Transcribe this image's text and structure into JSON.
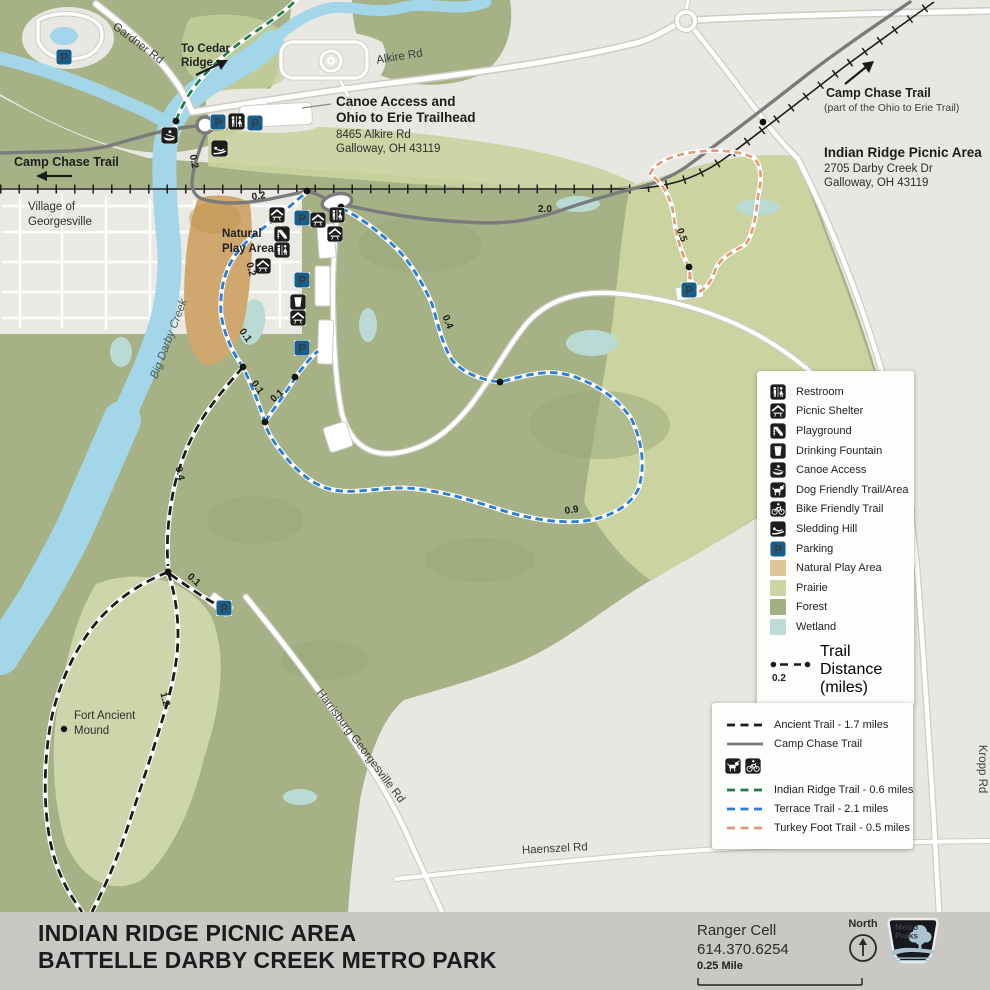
{
  "map": {
    "parking_glyph": "P",
    "roads": {
      "gardner": "Gardner Rd",
      "alkire": "Alkire Rd",
      "kropp": "Kropp Rd",
      "harrisburg": "Harrisburg Georgesville Rd",
      "haenszel": "Haenszel Rd"
    },
    "labels": {
      "to_cedar_1": "To Cedar",
      "to_cedar_2": "Ridge",
      "camp_chase_west": "Camp Chase Trail",
      "village_1": "Village of",
      "village_2": "Georgesville",
      "trailhead_title_1": "Canoe Access and",
      "trailhead_title_2": "Ohio to Erie Trailhead",
      "trailhead_addr_1": "8465 Alkire Rd",
      "trailhead_addr_2": "Galloway, OH 43119",
      "camp_chase_ne_1": "Camp Chase Trail",
      "camp_chase_ne_2": "(part of the Ohio to Erie Trail)",
      "picnic_title": "Indian Ridge Picnic Area",
      "picnic_addr_1": "2705 Darby Creek Dr",
      "picnic_addr_2": "Galloway, OH 43119",
      "natural_play_1": "Natural",
      "natural_play_2": "Play Area",
      "big_darby_creek": "Big Darby Creek",
      "fort_ancient_1": "Fort Ancient",
      "fort_ancient_2": "Mound"
    },
    "distances": {
      "d1": "0.2",
      "d2": "0.2",
      "d3": "0.2",
      "d4": "0.1",
      "d5": "0.1",
      "d6": "0.1",
      "d7": "0.1",
      "d8": "0.4",
      "d9": "0.4",
      "d10": "0.9",
      "d11": "1.2",
      "d12": "2.0",
      "d13": "0.5"
    }
  },
  "legend": {
    "items": [
      {
        "icon": "restroom-icon",
        "label": "Restroom"
      },
      {
        "icon": "picnic-shelter-icon",
        "label": "Picnic Shelter"
      },
      {
        "icon": "playground-icon",
        "label": "Playground"
      },
      {
        "icon": "drinking-fountain-icon",
        "label": "Drinking Fountain"
      },
      {
        "icon": "canoe-access-icon",
        "label": "Canoe Access"
      },
      {
        "icon": "dog-friendly-icon",
        "label": "Dog Friendly Trail/Area"
      },
      {
        "icon": "bike-friendly-icon",
        "label": "Bike Friendly Trail"
      },
      {
        "icon": "sledding-hill-icon",
        "label": "Sledding Hill"
      },
      {
        "icon": "parking-icon",
        "label": "Parking"
      },
      {
        "swatch": "#dcc79b",
        "label": "Natural Play Area"
      },
      {
        "swatch": "#cdd5a1",
        "label": "Prairie"
      },
      {
        "swatch": "#a2b080",
        "label": "Forest"
      },
      {
        "swatch": "#bedcd5",
        "label": "Wetland"
      }
    ],
    "trail_distance": {
      "value": "0.2",
      "label": "Trail Distance (miles)"
    }
  },
  "trail_legend": {
    "items": [
      {
        "name": "Ancient Trail - 1.7 miles",
        "color": "#1b1b19",
        "style": "dashed"
      },
      {
        "name": "Camp Chase Trail",
        "color": "#7b7b7d",
        "style": "solid"
      },
      {
        "name": "Indian Ridge Trail - 0.6 miles",
        "color": "#207a4b",
        "style": "dashed"
      },
      {
        "name": "Terrace Trail - 2.1 miles",
        "color": "#2b7fd4",
        "style": "dashed"
      },
      {
        "name": "Turkey Foot Trail - 0.5 miles",
        "color": "#dd9d78",
        "style": "dashed"
      }
    ]
  },
  "footer": {
    "title_line1": "INDIAN RIDGE PICNIC AREA",
    "title_line2": "BATTELLE DARBY CREEK METRO PARK",
    "ranger_label": "Ranger Cell",
    "ranger_phone": "614.370.6254",
    "scale_label": "0.25 Mile",
    "north_label": "North",
    "logo_line1": "Metro",
    "logo_line2": "Parks"
  },
  "colors": {
    "background_gray": "#e9e7e2",
    "forest": "#a6b286",
    "prairie": "#cbd4a0",
    "meadow": "#ccd6aa",
    "natural_play_area": "#cfa76f",
    "wetland": "#b9dbd3",
    "water": "#a3d6e8",
    "road_white": "#ffffff",
    "road_casing": "#cfccc6",
    "railroad": "#1d1d1b",
    "camp_chase_gray": "#7b7b7d",
    "ancient_trail": "#1b1b19",
    "indian_ridge_trail": "#207a4b",
    "terrace_trail": "#2b7fd4",
    "turkey_foot_trail": "#dd9d78",
    "parking_blue": "#175e8a",
    "icon_black": "#1d1d1b",
    "footer_bar": "#c9c8c4"
  }
}
